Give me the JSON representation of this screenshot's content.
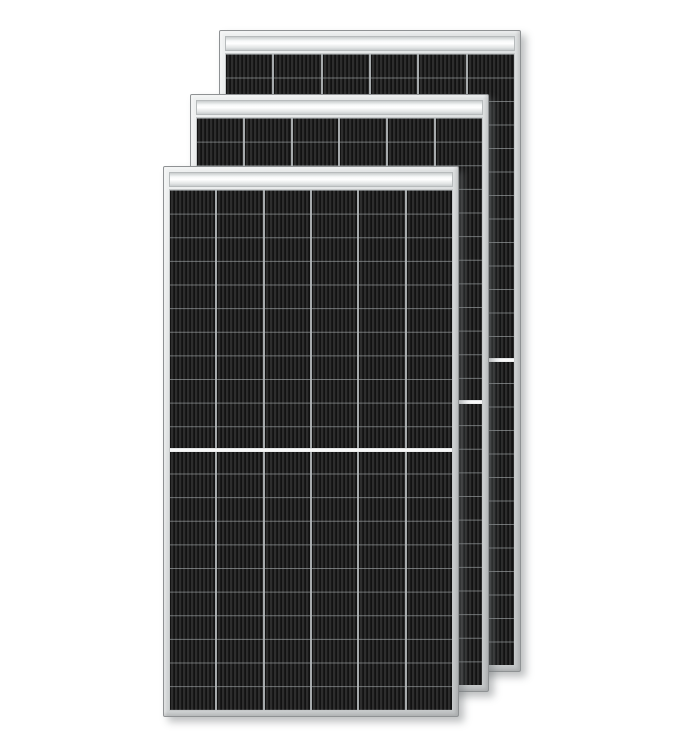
{
  "scene": {
    "description": "Three black half-cut-cell solar panels with silver aluminum frames, stacked front to back on a white background",
    "background": "#ffffff"
  },
  "colors": {
    "background": "#ffffff",
    "frame": "#d2d5d6",
    "frame_edge": "#8f9294",
    "frame_highlight": "#eff1f1",
    "top_strip": "#f7f9f9",
    "top_strip_shade": "#c9cdce",
    "cell_dark": "#1f1f1f",
    "cell_stripe": "#2d2d2d",
    "column_gap": "#a7abad",
    "row_line": "#8e9396",
    "divider": "#ffffff",
    "shadow": "rgba(110,115,118,0.45)"
  },
  "panels": [
    {
      "name": "solar-panel-rear",
      "left": 219,
      "top": 30,
      "width": 302,
      "height": 642,
      "z": 1,
      "columns": 6,
      "rows_per_half": 13
    },
    {
      "name": "solar-panel-middle",
      "left": 190,
      "top": 94,
      "width": 299,
      "height": 598,
      "z": 2,
      "columns": 6,
      "rows_per_half": 12
    },
    {
      "name": "solar-panel-front",
      "left": 163,
      "top": 166,
      "width": 296,
      "height": 551,
      "z": 3,
      "columns": 6,
      "rows_per_half": 11
    }
  ]
}
